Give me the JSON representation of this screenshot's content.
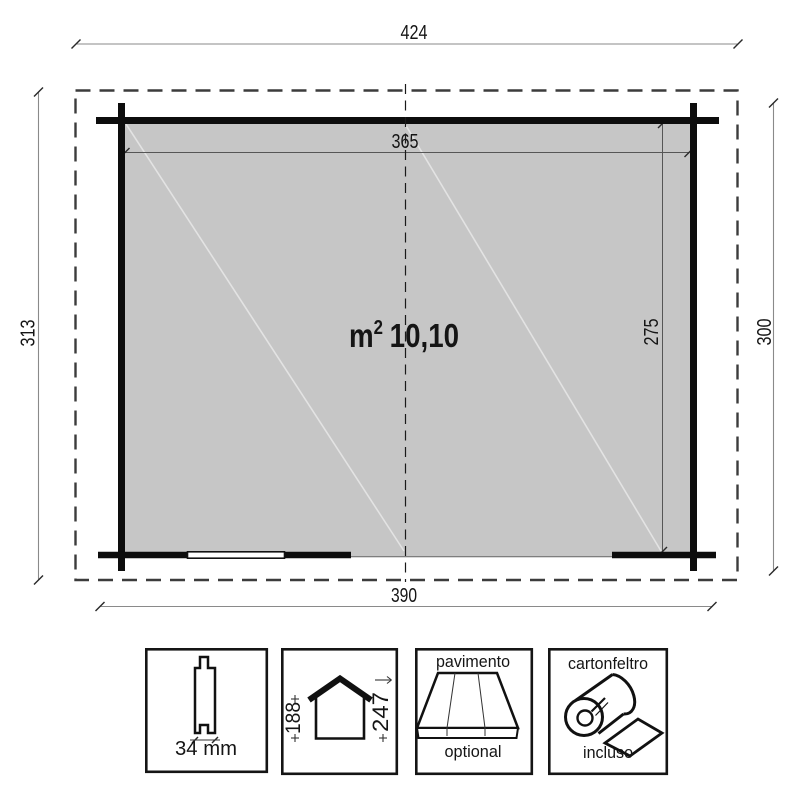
{
  "plan": {
    "area": {
      "unit": "m",
      "sup": "2",
      "value": "10,10"
    },
    "dims": {
      "roof_width": "424",
      "inner_width": "365",
      "left_depth": "313",
      "right_depth": "300",
      "inner_depth": "275",
      "bottom_width": "390"
    }
  },
  "legend": {
    "plank": {
      "label": "34 mm"
    },
    "heights": {
      "eave": "188",
      "ridge": "247"
    },
    "floor": {
      "top": "pavimento",
      "bottom": "optional"
    },
    "felt": {
      "top": "cartonfeltro",
      "bottom": "incluso"
    }
  },
  "colors": {
    "floor": "#c6c6c6",
    "wall": "#0d0d0d",
    "dim_line": "#8a8a8a",
    "text": "#151515"
  }
}
